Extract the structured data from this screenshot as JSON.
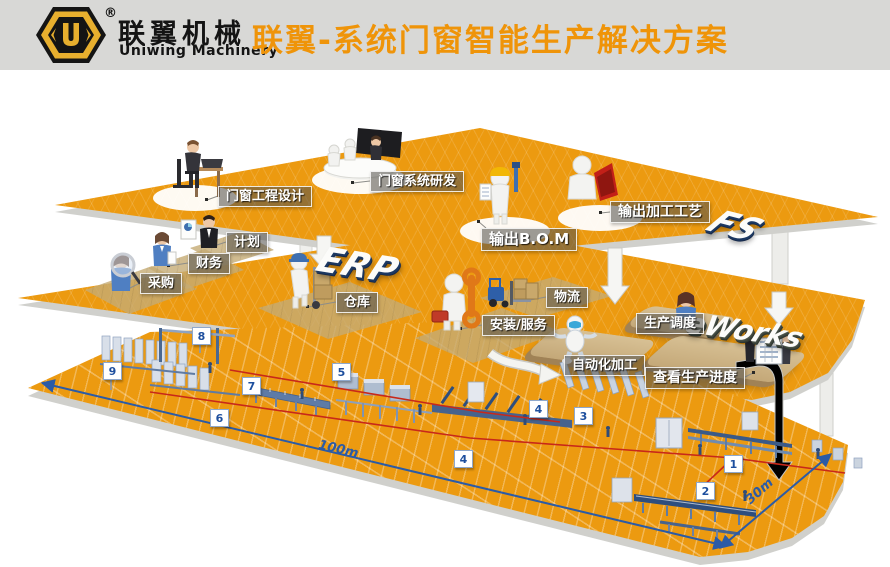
{
  "header": {
    "title": "联翼-系统门窗智能生产解决方案",
    "logo": {
      "letter": "U",
      "registered": "®",
      "brand_cn": "联翼机械",
      "brand_en": "Uniwing Machinery"
    }
  },
  "platforms": {
    "fs": {
      "badge": "FS",
      "stations": [
        {
          "label": "门窗工程设计"
        },
        {
          "label": "门窗系统研发"
        },
        {
          "label": "输出B.O.M"
        },
        {
          "label": "输出加工工艺"
        }
      ]
    },
    "erp": {
      "badge": "ERP",
      "stations": [
        {
          "label": "计划"
        },
        {
          "label": "财务"
        },
        {
          "label": "采购"
        },
        {
          "label": "仓库"
        },
        {
          "label": "物流"
        },
        {
          "label": "安装/服务"
        }
      ]
    },
    "eworks": {
      "badge": "eWorks",
      "stations": [
        {
          "label": "生产调度"
        },
        {
          "label": "自动化加工"
        },
        {
          "label": "查看生产进度"
        }
      ]
    }
  },
  "factory": {
    "markers": [
      "1",
      "2",
      "3",
      "4",
      "4",
      "5",
      "6",
      "7",
      "8",
      "9"
    ],
    "dim_length": "100m",
    "dim_width": "30m"
  },
  "colors": {
    "accent_orange": "#ef9409",
    "platform_orange": "#ec9a10",
    "dimension_blue": "#2b5ba6",
    "path_red": "#c8281a"
  }
}
